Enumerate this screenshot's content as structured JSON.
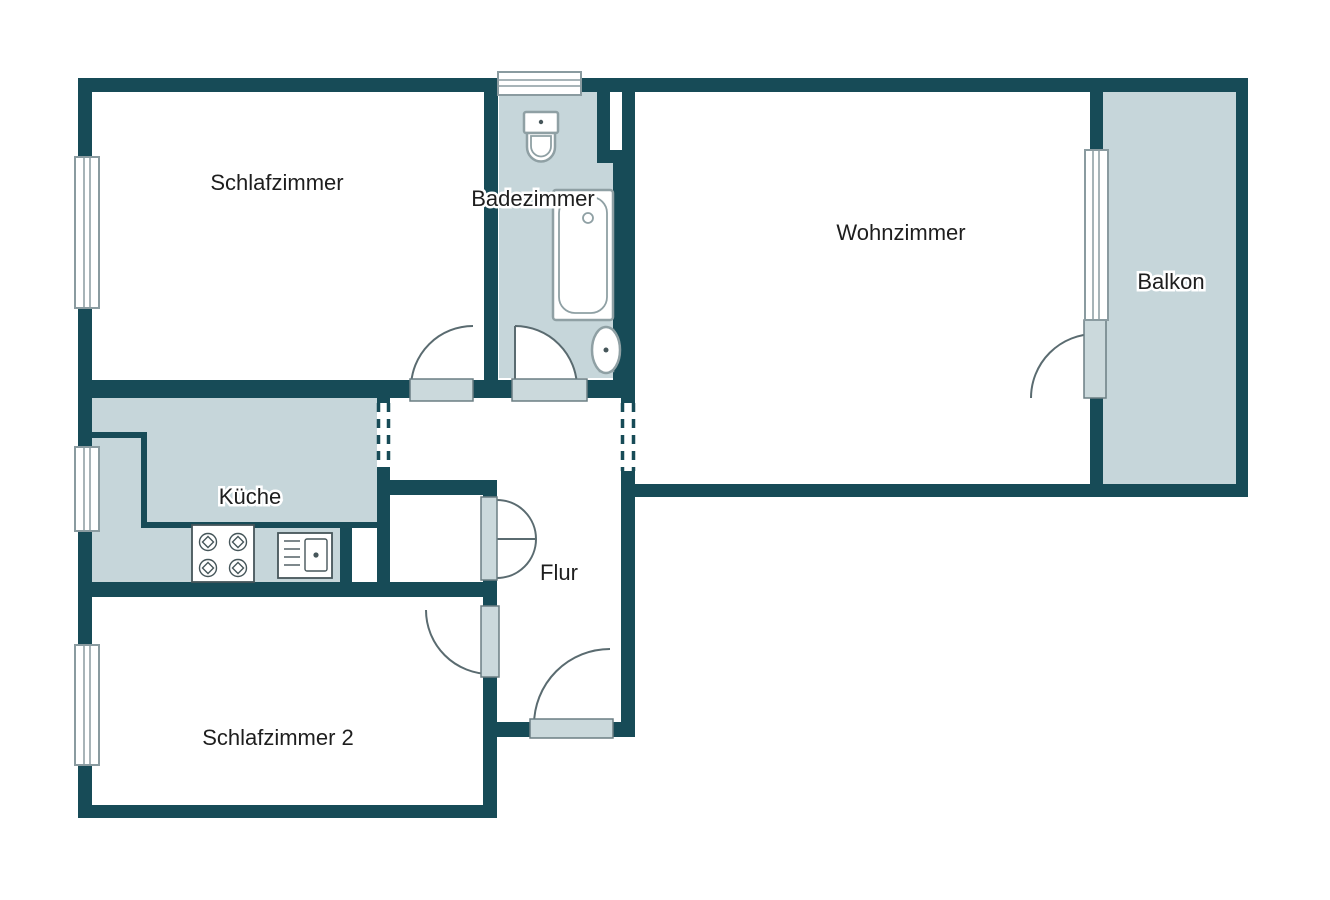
{
  "floorplan": {
    "type": "apartment-floor-plan",
    "rooms": {
      "schlafzimmer": {
        "label": "Schlafzimmer"
      },
      "badezimmer": {
        "label": "Badezimmer"
      },
      "wohnzimmer": {
        "label": "Wohnzimmer"
      },
      "balkon": {
        "label": "Balkon"
      },
      "kueche": {
        "label": "Küche"
      },
      "flur": {
        "label": "Flur"
      },
      "schlafzimmer2": {
        "label": "Schlafzimmer 2"
      }
    },
    "fixtures": [
      "toilet",
      "bathtub",
      "washbasin",
      "stove",
      "kitchen-sink"
    ],
    "colors": {
      "wall": "#174B57",
      "room_fill": "#C6D6DA",
      "door_sill_fill": "#CBD9DC",
      "door_sill_stroke": "#6B7E83",
      "window_stroke": "#8A9BA0",
      "arc_line": "#5A6B70",
      "fixture_outline": "#8FA0A4",
      "kitchen_fixture_outline": "#46565A",
      "label_text": "#1E1E1E"
    }
  }
}
